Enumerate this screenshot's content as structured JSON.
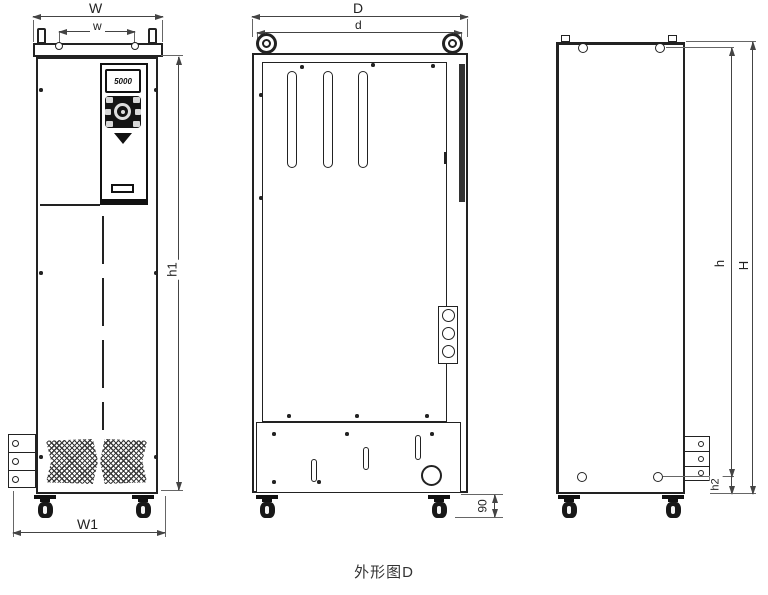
{
  "caption": "外形图D",
  "front_view": {
    "label": "front view with keypad",
    "display_value": "5000",
    "dims": {
      "outer_width": "W",
      "hole_spacing": "w",
      "body_height": "h1",
      "base_width": "W1"
    }
  },
  "side_view": {
    "label": "side view with lifting eyes",
    "dims": {
      "outer_depth": "D",
      "inner_depth": "d",
      "caster_height": "90"
    }
  },
  "rear_view": {
    "label": "rear view",
    "dims": {
      "hole_height": "h",
      "overall_height": "H",
      "foot_height": "h2"
    }
  },
  "icons": {
    "lifting-eye-icon": "double-circle-ring",
    "lifting-lug-icon": "small-post",
    "caster-wheel-icon": "swivel-caster",
    "vent-icon": "crosshatched-chevron",
    "keypad-knob-icon": "round-navigation-dial",
    "keypad-arrow-icon": "solid-triangle-down"
  },
  "colors": {
    "line": "#222222",
    "dimension_line": "#444444",
    "background": "#ffffff"
  }
}
